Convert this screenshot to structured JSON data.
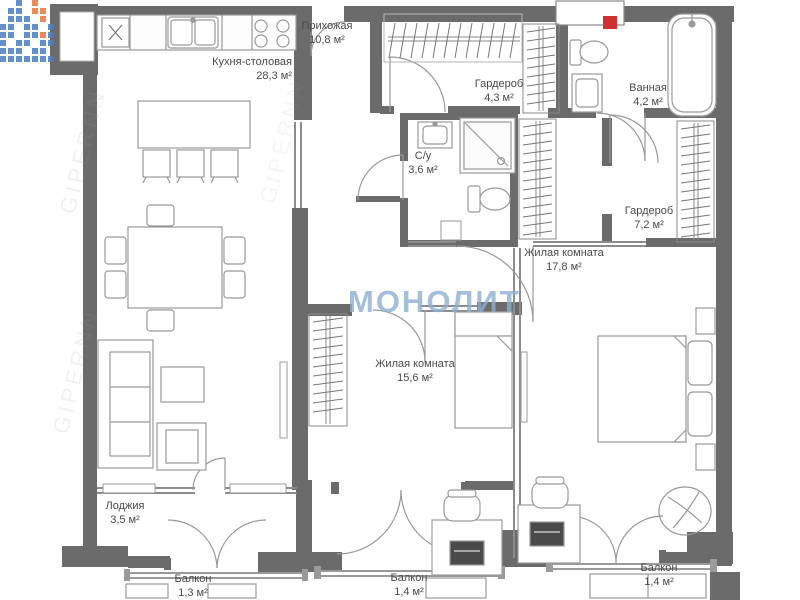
{
  "title": "Floor plan",
  "watermark": {
    "brand": "МОНОЛИТ",
    "site": "GIPERNN"
  },
  "colors": {
    "wall": "#6b6b6b",
    "thin_wall": "#8c8c8c",
    "fixture_line": "#999999",
    "riser_red": "#d03030",
    "brand_blue": "#8fafd2",
    "logo_blue": "#4d7fc0",
    "logo_orange": "#e2763b"
  },
  "rooms": [
    {
      "id": "hallway",
      "name": "Прихожая",
      "area": "10,8 м²"
    },
    {
      "id": "kitchen",
      "name": "Кухня-столовая",
      "area": "28,3 м²"
    },
    {
      "id": "wardrobe-small",
      "name": "Гардероб",
      "area": "4,3 м²"
    },
    {
      "id": "bathroom",
      "name": "Ванная",
      "area": "4,2 м²"
    },
    {
      "id": "wc",
      "name": "С/у",
      "area": "3,6 м²"
    },
    {
      "id": "wardrobe-large",
      "name": "Гардероб",
      "area": "7,2 м²"
    },
    {
      "id": "living-room-1",
      "name": "Жилая комната",
      "area": "17,8 м²"
    },
    {
      "id": "living-room-2",
      "name": "Жилая комната",
      "area": "15,6 м²"
    },
    {
      "id": "loggia",
      "name": "Лоджия",
      "area": "3,5 м²"
    },
    {
      "id": "balcony-left",
      "name": "Балкон",
      "area": "1,3 м²"
    },
    {
      "id": "balcony-middle",
      "name": "Балкон",
      "area": "1,4 м²"
    },
    {
      "id": "balcony-right",
      "name": "Балкон",
      "area": "1,4 м²"
    }
  ]
}
